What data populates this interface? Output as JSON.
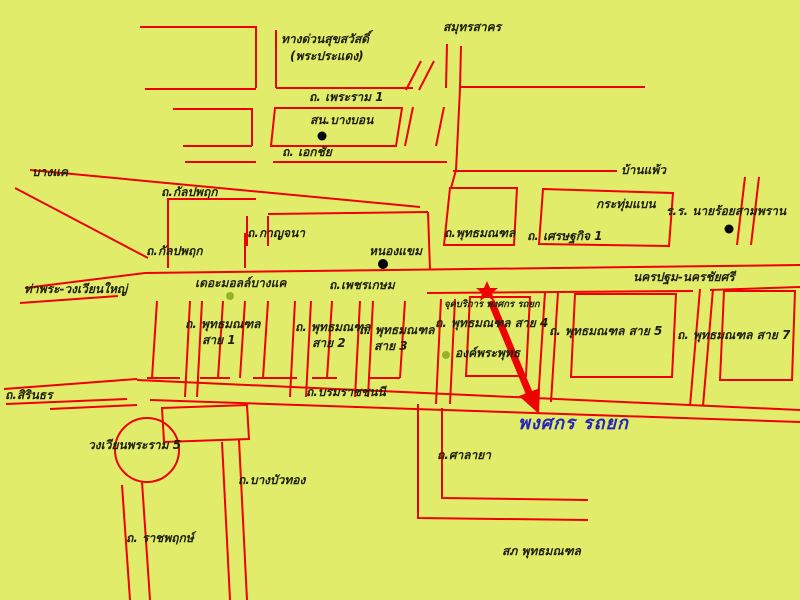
{
  "map": {
    "background_color": "#e0ec6a",
    "road_color": "#ee0000",
    "label_color": "#1f1f0a",
    "highlight_color": "#2424bd",
    "landmark_dot_color": "#000000",
    "poi_dot_color": "#95b229",
    "labels": {
      "expressway_name": "ทางด่วนสุขสวัสดิ์",
      "expressway_sub": "(พระประแดง)",
      "samut_sakhon": "สมุทรสาคร",
      "rama1_road": "ถ. เพระราม 1",
      "bang_bon_station": "สน.บางบอน",
      "ekachai_road": "ถ. เอกชัย",
      "bang_khae": "บางแค",
      "kanlapaphruek_road_upper": "ถ.กัลปพฤก",
      "kanlapaphruek_road_lower": "ถ.กัลปพฤก",
      "kanchana_road": "ถ.กาญจนา",
      "nong_khaem": "หนองแขม",
      "phetkasem_road": "ถ.เพชรเกษม",
      "the_mall_bang_khae": "เดอะมอลล์บางแค",
      "tha_phra_wongwian_yai": "ท่าพระ-วงเวียนใหญ่",
      "phutthamonthon_road": "ถ.พุทธมณฑล",
      "setthakit_road": "ถ. เศรษฐกิจ 1",
      "krathum_baen": "กระทุ่มแบน",
      "ban_phaeo": "บ้านแพ้ว",
      "cadet_school": "ร.ร. นายร้อยสามพราน",
      "nakhon_pathom_nakhon_chai_si": "นครปฐม-นครชัยศรี",
      "service_point": "จุดบริการ พงศกร รถยก",
      "sai1_line1": "ถ. พุทธมณฑล",
      "sai1_line2": "สาย 1",
      "sai2_line1": "ถ. พุทธมณฑล",
      "sai2_line2": "สาย 2",
      "sai3_line1": "ถ. พุทธมณฑล",
      "sai3_line2": "สาย 3",
      "sai4_road": "ถ. พุทธมณฑล สาย 4",
      "sai5_road": "ถ. พุทธมณฑล สาย 5",
      "sai7_road": "ถ. พุทธมณฑล สาย 7",
      "buddha_monument": "องค์พระพุทธ",
      "sirindhorn_road": "ถ.สิรินธร",
      "borommaratchachonnani_road": "ถ.บรมราชชนนี",
      "phongsakorn_towing": "พงศกร รถยก",
      "rama5_roundabout": "วงเวียนพระราม 5",
      "salaya_road": "ถ.ศาลายา",
      "bang_bua_thong_road": "ถ.บางบัวทอง",
      "ratchaphruek_road": "ถ. ราชพฤกษ์",
      "police_station": "สภ พุทธมณฑล"
    },
    "markers": {
      "service_star": "red-star",
      "service_arrow": "red-arrow",
      "black_dots": [
        "สน.บางบอน",
        "หนองแขม",
        "ร.ร. นายร้อยสามพราน"
      ],
      "green_dots": [
        "เดอะมอลล์บางแค",
        "องค์พระพุทธ"
      ]
    }
  }
}
